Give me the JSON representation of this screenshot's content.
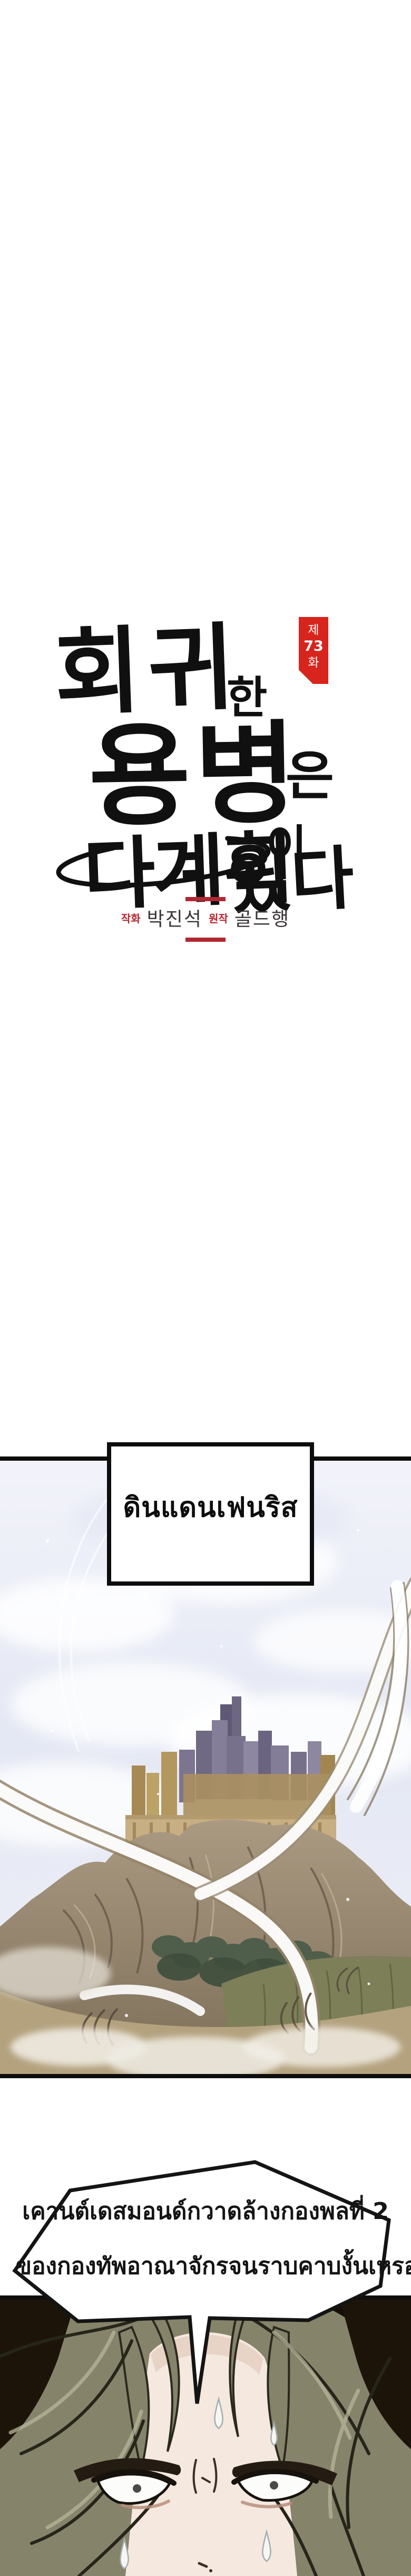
{
  "page": {
    "kind": "webtoon-episode-page",
    "background": "#ffffff"
  },
  "header": {
    "episode_badge": {
      "prefix": "제",
      "number": "73",
      "suffix": "화",
      "bg_color": "#d7251d",
      "text_color": "#ffffff"
    },
    "title": {
      "full": "회귀한 용병은 다 계획이 있다",
      "parts": [
        "회귀",
        "한",
        "용병",
        "은",
        "다계획",
        "이",
        "있다"
      ],
      "ink_color": "#101010"
    },
    "credits": {
      "art_label": "작화",
      "art_name": "박진석",
      "original_label": "원작",
      "original_name": "골드행",
      "label_color": "#b5242e",
      "name_color": "#3a3537",
      "divider_color": "#b12732"
    }
  },
  "scene": {
    "location_label": "ดินแดนเฟนริส",
    "description": "walled city with towers on a rocky hill, green slopes, swirling wind",
    "sky_color": "#e9ecf6",
    "hill_color": "#9a8a72",
    "ground_color": "#b4a27e",
    "panel_border_color": "#0d0d0d"
  },
  "dialogue": {
    "line1": "เคานต์เดสมอนด์กวาดล้างกองพลที่ 2",
    "line2": "ของกองทัพอาณาจักรจนราบคาบงั้นเหรอ...!?",
    "bubble_fill": "#ffffff",
    "bubble_stroke": "#141414"
  },
  "character": {
    "description": "angry sweating man close-up, olive-green hair, furrowed brows",
    "hair_color": "#85836a",
    "skin_color": "#f4e8df",
    "background_color": "#241a10"
  }
}
